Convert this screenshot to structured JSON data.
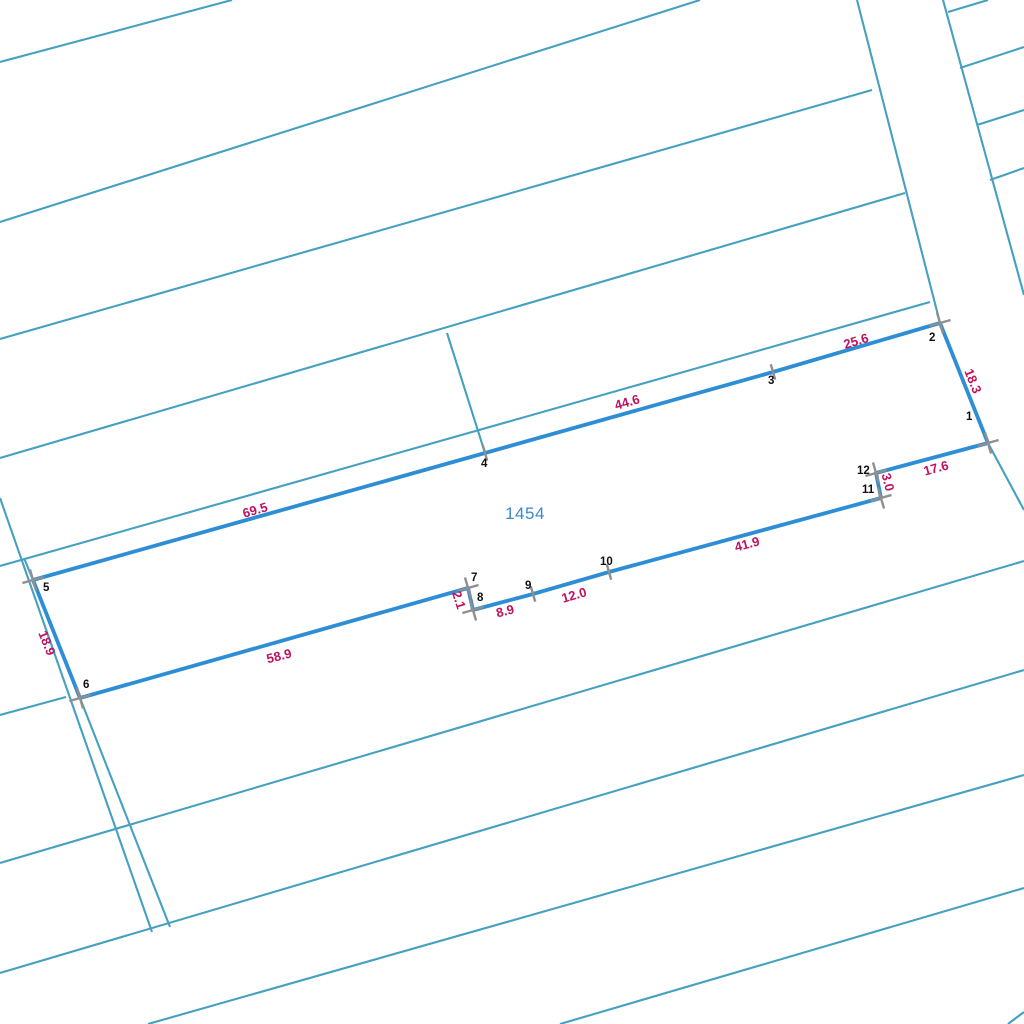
{
  "canvas": {
    "width": 1024,
    "height": 1024,
    "background_color": "#ffffff"
  },
  "colors": {
    "cadastral_line": "#46a0bf",
    "selected_parcel_line": "#2e8ed5",
    "vertex_marker": "#8f8f8f",
    "dimension_text": "#bf1160",
    "vertex_number_text": "#111111",
    "parcel_id_text": "#3a87cd"
  },
  "parcel": {
    "id_label": "1454",
    "id_label_pos": {
      "x": 525,
      "y": 514
    },
    "boundary": [
      [
        988,
        443
      ],
      [
        940,
        323
      ],
      [
        773,
        372
      ],
      [
        485,
        453
      ],
      [
        33,
        580
      ],
      [
        80,
        698
      ],
      [
        468,
        588
      ],
      [
        473,
        610
      ],
      [
        533,
        594
      ],
      [
        609,
        572
      ],
      [
        881,
        498
      ],
      [
        876,
        473
      ]
    ],
    "vertices": [
      {
        "n": "1",
        "x": 988,
        "y": 443,
        "marker": "cross",
        "lx": 966,
        "ly": 411
      },
      {
        "n": "2",
        "x": 940,
        "y": 323,
        "marker": "cross",
        "lx": 929,
        "ly": 332
      },
      {
        "n": "3",
        "x": 773,
        "y": 372,
        "marker": "tick",
        "lx": 768,
        "ly": 375
      },
      {
        "n": "4",
        "x": 485,
        "y": 453,
        "marker": "tick",
        "lx": 481,
        "ly": 458
      },
      {
        "n": "5",
        "x": 33,
        "y": 580,
        "marker": "cross",
        "lx": 43,
        "ly": 582
      },
      {
        "n": "6",
        "x": 80,
        "y": 698,
        "marker": "cross",
        "lx": 83,
        "ly": 679
      },
      {
        "n": "7",
        "x": 468,
        "y": 588,
        "marker": "cross",
        "lx": 471,
        "ly": 572
      },
      {
        "n": "8",
        "x": 473,
        "y": 610,
        "marker": "cross",
        "lx": 477,
        "ly": 592
      },
      {
        "n": "9",
        "x": 533,
        "y": 594,
        "marker": "tick",
        "lx": 525,
        "ly": 580
      },
      {
        "n": "10",
        "x": 609,
        "y": 572,
        "marker": "tick",
        "lx": 600,
        "ly": 556
      },
      {
        "n": "11",
        "x": 881,
        "y": 498,
        "marker": "cross",
        "lx": 862,
        "ly": 484
      },
      {
        "n": "12",
        "x": 876,
        "y": 473,
        "marker": "cross",
        "lx": 857,
        "ly": 465
      }
    ],
    "dimensions": [
      {
        "text": "25.6",
        "x": 856,
        "y": 341,
        "rot": -17
      },
      {
        "text": "18.3",
        "x": 973,
        "y": 381,
        "rot": 68
      },
      {
        "text": "44.6",
        "x": 627,
        "y": 402,
        "rot": -16
      },
      {
        "text": "17.6",
        "x": 936,
        "y": 468,
        "rot": -15
      },
      {
        "text": "3.0",
        "x": 888,
        "y": 482,
        "rot": 76
      },
      {
        "text": "41.9",
        "x": 747,
        "y": 544,
        "rot": -15
      },
      {
        "text": "12.0",
        "x": 574,
        "y": 595,
        "rot": -16
      },
      {
        "text": "8.9",
        "x": 505,
        "y": 611,
        "rot": -14
      },
      {
        "text": "2.1",
        "x": 459,
        "y": 600,
        "rot": 72
      },
      {
        "text": "58.9",
        "x": 279,
        "y": 656,
        "rot": -14
      },
      {
        "text": "18.9",
        "x": 47,
        "y": 643,
        "rot": 68
      },
      {
        "text": "69.5",
        "x": 255,
        "y": 510,
        "rot": -16
      }
    ]
  },
  "background_lines": [
    {
      "x1": 0,
      "y1": 62,
      "x2": 232,
      "y2": 0
    },
    {
      "x1": 0,
      "y1": 222,
      "x2": 700,
      "y2": 0
    },
    {
      "x1": 0,
      "y1": 339,
      "x2": 872,
      "y2": 90
    },
    {
      "x1": 0,
      "y1": 458,
      "x2": 905,
      "y2": 193
    },
    {
      "x1": 0,
      "y1": 566,
      "x2": 930,
      "y2": 302
    },
    {
      "x1": 0,
      "y1": 715,
      "x2": 66,
      "y2": 697
    },
    {
      "x1": 0,
      "y1": 863,
      "x2": 1024,
      "y2": 561
    },
    {
      "x1": 0,
      "y1": 973,
      "x2": 1024,
      "y2": 670
    },
    {
      "x1": 148,
      "y1": 1024,
      "x2": 1024,
      "y2": 775
    },
    {
      "x1": 560,
      "y1": 1024,
      "x2": 1024,
      "y2": 888
    },
    {
      "x1": 1008,
      "y1": 1024,
      "x2": 1024,
      "y2": 1012
    },
    {
      "x1": 0,
      "y1": 498,
      "x2": 152,
      "y2": 932
    },
    {
      "x1": 24,
      "y1": 558,
      "x2": 33,
      "y2": 580
    },
    {
      "x1": 80,
      "y1": 698,
      "x2": 170,
      "y2": 927
    },
    {
      "x1": 447,
      "y1": 333,
      "x2": 485,
      "y2": 453
    },
    {
      "x1": 857,
      "y1": 0,
      "x2": 940,
      "y2": 323
    },
    {
      "x1": 943,
      "y1": 0,
      "x2": 1024,
      "y2": 295
    },
    {
      "x1": 988,
      "y1": 443,
      "x2": 1024,
      "y2": 510
    },
    {
      "x1": 948,
      "y1": 12,
      "x2": 988,
      "y2": 0
    },
    {
      "x1": 960,
      "y1": 68,
      "x2": 1024,
      "y2": 47
    },
    {
      "x1": 977,
      "y1": 125,
      "x2": 1024,
      "y2": 110
    },
    {
      "x1": 990,
      "y1": 180,
      "x2": 1024,
      "y2": 168
    }
  ],
  "marker_style": {
    "cross_arm": 11,
    "tick_arm": 8,
    "stroke_width": 2.4,
    "cross_angle": -16,
    "tick_angle": 74
  }
}
